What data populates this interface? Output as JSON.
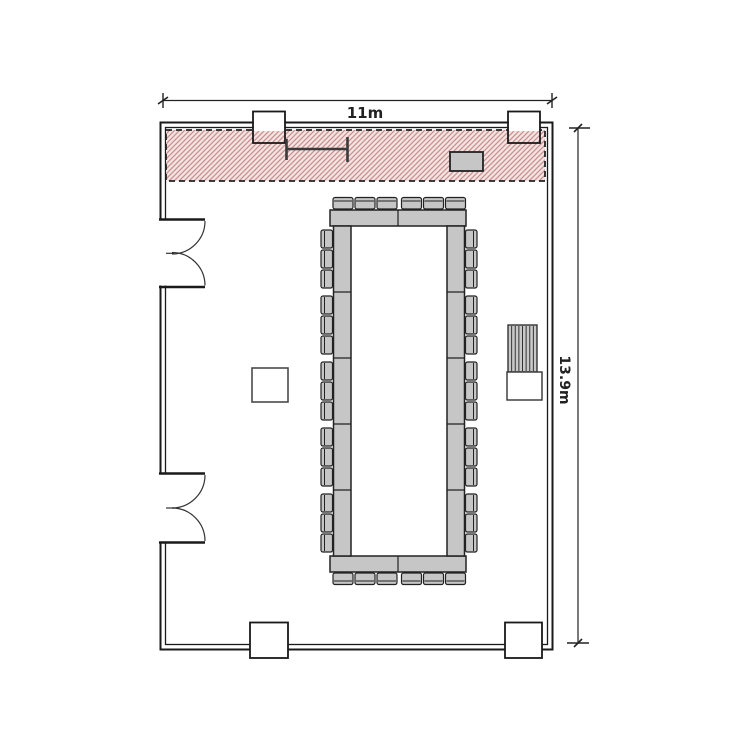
{
  "plan": {
    "title": "meeting-room-floor-plan",
    "room": {
      "width_label": "11m",
      "height_label": "13.9m",
      "width_m": 11,
      "height_m": 13.9
    }
  },
  "colors": {
    "wall_color": "#1a1a1a",
    "hatch_fill": "#f5e4e4",
    "hatch_line": "#c98f8f",
    "hatch_border": "#222222",
    "furniture_fill": "#c6c6c6"
  },
  "zones": {
    "restricted_strip": {
      "style": "red-diagonal-hatch",
      "border": "dashed"
    }
  },
  "furniture": {
    "table": {
      "type": "hollow-rectangle-boardroom",
      "seats_top": 6,
      "seats_bottom": 6,
      "seats_left": 15,
      "seats_right": 15,
      "seats_total": 42,
      "side_segments": 5,
      "end_segments": 2
    },
    "equipment_box_in_hatch": 1,
    "floor_box": 1,
    "service_fixture": {
      "parts": [
        "striped-top",
        "plain-base"
      ],
      "stripes": 7
    },
    "rail_fixture": 1,
    "pillars_top": 2,
    "pillars_bottom": 2,
    "double_doors_left": 2
  }
}
